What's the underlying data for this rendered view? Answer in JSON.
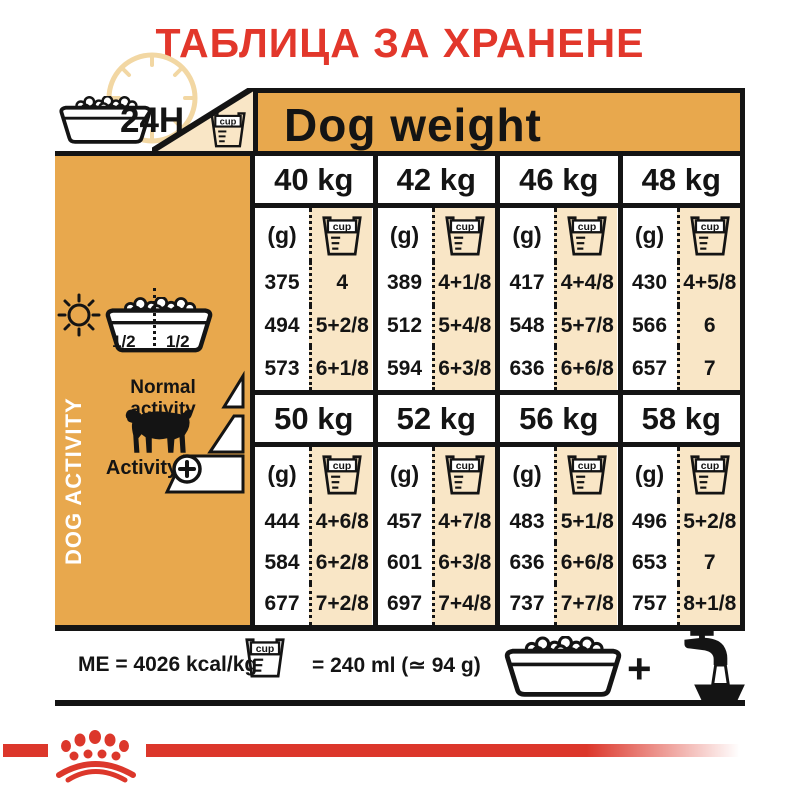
{
  "title": "ТАБЛИЦА ЗА ХРАНЕНЕ",
  "header": {
    "h24": "24H",
    "dog_weight": "Dog weight"
  },
  "labels": {
    "cup": "cup",
    "g": "(g)"
  },
  "sidebar": {
    "half_left": "1/2",
    "half_right": "1/2",
    "dog_activity": "DOG ACTIVITY",
    "normal_activity": "Normal activity",
    "activity": "Activity",
    "plus": "+"
  },
  "table": {
    "sections": [
      {
        "columns": [
          {
            "weight": "40 kg",
            "rows": [
              {
                "g": "375",
                "cup": "4"
              },
              {
                "g": "494",
                "cup": "5+2/8"
              },
              {
                "g": "573",
                "cup": "6+1/8"
              }
            ]
          },
          {
            "weight": "42 kg",
            "rows": [
              {
                "g": "389",
                "cup": "4+1/8"
              },
              {
                "g": "512",
                "cup": "5+4/8"
              },
              {
                "g": "594",
                "cup": "6+3/8"
              }
            ]
          },
          {
            "weight": "46 kg",
            "rows": [
              {
                "g": "417",
                "cup": "4+4/8"
              },
              {
                "g": "548",
                "cup": "5+7/8"
              },
              {
                "g": "636",
                "cup": "6+6/8"
              }
            ]
          },
          {
            "weight": "48 kg",
            "rows": [
              {
                "g": "430",
                "cup": "4+5/8"
              },
              {
                "g": "566",
                "cup": "6"
              },
              {
                "g": "657",
                "cup": "7"
              }
            ]
          }
        ]
      },
      {
        "columns": [
          {
            "weight": "50 kg",
            "rows": [
              {
                "g": "444",
                "cup": "4+6/8"
              },
              {
                "g": "584",
                "cup": "6+2/8"
              },
              {
                "g": "677",
                "cup": "7+2/8"
              }
            ]
          },
          {
            "weight": "52 kg",
            "rows": [
              {
                "g": "457",
                "cup": "4+7/8"
              },
              {
                "g": "601",
                "cup": "6+3/8"
              },
              {
                "g": "697",
                "cup": "7+4/8"
              }
            ]
          },
          {
            "weight": "56 kg",
            "rows": [
              {
                "g": "483",
                "cup": "5+1/8"
              },
              {
                "g": "636",
                "cup": "6+6/8"
              },
              {
                "g": "737",
                "cup": "7+7/8"
              }
            ]
          },
          {
            "weight": "58 kg",
            "rows": [
              {
                "g": "496",
                "cup": "5+2/8"
              },
              {
                "g": "653",
                "cup": "7"
              },
              {
                "g": "757",
                "cup": "8+1/8"
              }
            ]
          }
        ]
      }
    ]
  },
  "footer": {
    "me": "ME = 4026 kcal/kg",
    "cup_equals": "= 240 ml (≃ 94 g)",
    "plus": "+"
  },
  "colors": {
    "gold": "#E8A84D",
    "cream": "#F9E6C6",
    "red": "#E2372B",
    "stripe": "#DC372B",
    "paleclock": "#F2D7A3"
  }
}
